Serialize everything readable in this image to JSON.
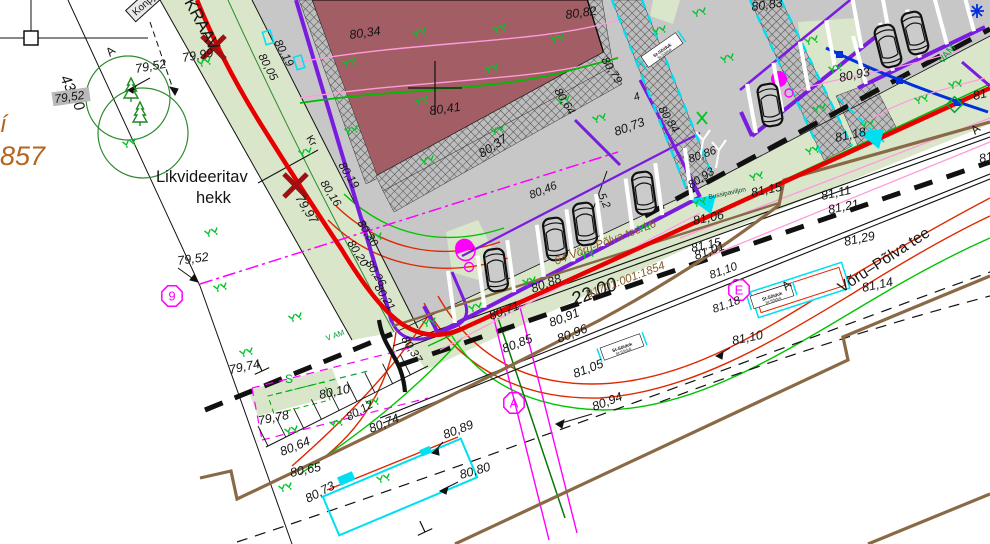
{
  "drawing_meta": {
    "type": "cad-site-plan",
    "road_name": "Võru–Põlva tee",
    "cadastral_number": "91701:001:1854",
    "address_label": "64 Võru-Põlva tee L6",
    "corridor_width": "22.00",
    "boundary_dimension": "43,00",
    "hedge_note": "Likvideeritav hekk",
    "ditch_label": "KRAAV",
    "bus_shelter_label": "Bussipaviljon"
  },
  "colors": {
    "k": "#151515",
    "o": "#b5651d",
    "g": "#00a33a",
    "b": "#8a5a2b",
    "d": "#063f1e",
    "pavement": "#c7c7c7",
    "lawn": "#d9e6c9",
    "building": "#a35d64",
    "red": "#e80000",
    "purple": "#7a1be0",
    "cyan": "#00dff0",
    "magenta": "#ff00ff",
    "brown": "#8a6a46",
    "blue": "#0030dd",
    "pink": "#ff9bdd",
    "green": "#00c400"
  },
  "texts": [
    {
      "t": "43,00",
      "x": 60,
      "y": 78,
      "r": 64,
      "s": 15,
      "n": "dimension-label"
    },
    {
      "t": "Konpju",
      "x": 136,
      "y": 16,
      "r": -42,
      "s": 10,
      "u": 1,
      "box": 1,
      "n": "boxed-note-label"
    },
    {
      "t": "A",
      "x": 110,
      "y": 57,
      "r": -40,
      "s": 12,
      "u": 1,
      "n": "axis-letter"
    },
    {
      "t": "79,52",
      "x": 136,
      "y": 73,
      "r": -10
    },
    {
      "t": "79,52",
      "x": 55,
      "y": 103,
      "r": -8,
      "s": 12,
      "bg": 1
    },
    {
      "t": "í",
      "x": 0,
      "y": 132,
      "s": 24,
      "c": "o",
      "n": "cut-text"
    },
    {
      "t": "857",
      "x": 0,
      "y": 165,
      "s": 27,
      "c": "o",
      "n": "cut-cadastral"
    },
    {
      "t": "Likvideeritav",
      "x": 156,
      "y": 182,
      "s": 16.5,
      "u": 1,
      "n": "hedge-note-line1"
    },
    {
      "t": "hekk",
      "x": 196,
      "y": 203,
      "s": 16.5,
      "u": 1,
      "n": "hedge-note-line2"
    },
    {
      "t": "79,52",
      "x": 178,
      "y": 265,
      "r": -8
    },
    {
      "t": "79,99",
      "x": 183,
      "y": 62,
      "r": -10
    },
    {
      "t": "KRAAV",
      "x": 184,
      "y": 2,
      "r": 62,
      "s": 17,
      "u": 1,
      "n": "ditch-label"
    },
    {
      "t": "80,05",
      "x": 258,
      "y": 56,
      "r": 62,
      "s": 11.5
    },
    {
      "t": "80,19",
      "x": 274,
      "y": 42,
      "r": 62,
      "s": 11.5
    },
    {
      "t": "Kr",
      "x": 306,
      "y": 138,
      "r": 58,
      "s": 10.5,
      "u": 1,
      "n": "note-label"
    },
    {
      "t": "80,19",
      "x": 338,
      "y": 165,
      "r": 58,
      "s": 11.5
    },
    {
      "t": "80,16",
      "x": 320,
      "y": 183,
      "r": 58,
      "s": 11.5
    },
    {
      "t": "79,97",
      "x": 295,
      "y": 198,
      "r": 58
    },
    {
      "t": "80,30",
      "x": 357,
      "y": 223,
      "r": 58,
      "s": 11.5
    },
    {
      "t": "80,20",
      "x": 347,
      "y": 243,
      "r": 58,
      "s": 11.5
    },
    {
      "t": "80,26",
      "x": 365,
      "y": 263,
      "r": 58,
      "s": 11.5
    },
    {
      "t": "80,21",
      "x": 374,
      "y": 287,
      "r": 58,
      "s": 11.5
    },
    {
      "t": "80,37",
      "x": 401,
      "y": 339,
      "r": 58,
      "s": 11.5
    },
    {
      "t": "80,10",
      "x": 320,
      "y": 399,
      "r": -12
    },
    {
      "t": "80,34",
      "x": 350,
      "y": 39,
      "r": -8
    },
    {
      "t": "80,82",
      "x": 566,
      "y": 19,
      "r": -8
    },
    {
      "t": "80,41",
      "x": 430,
      "y": 115,
      "r": -8
    },
    {
      "t": "80,64",
      "x": 554,
      "y": 91,
      "r": 58,
      "s": 11.5
    },
    {
      "t": "80,37",
      "x": 482,
      "y": 158,
      "r": -33
    },
    {
      "t": "80,73",
      "x": 616,
      "y": 136,
      "r": -20
    },
    {
      "t": "80,84",
      "x": 658,
      "y": 109,
      "r": 58,
      "s": 11.5
    },
    {
      "t": "80,86",
      "x": 690,
      "y": 163,
      "r": -20,
      "s": 11.5
    },
    {
      "t": "80,46",
      "x": 531,
      "y": 199,
      "r": -22,
      "s": 11.5
    },
    {
      "t": "5,2",
      "x": 598,
      "y": 195,
      "r": 66,
      "s": 11,
      "n": "dimension-label"
    },
    {
      "t": "4",
      "x": 635,
      "y": 101,
      "r": -20,
      "s": 11,
      "n": "dimension-label"
    },
    {
      "t": "80,79",
      "x": 601,
      "y": 60,
      "r": 58,
      "s": 11.5
    },
    {
      "t": "80,83",
      "x": 752,
      "y": 11,
      "r": -8
    },
    {
      "t": "80,93",
      "x": 691,
      "y": 189,
      "r": -33,
      "s": 11.5
    },
    {
      "t": "80,93",
      "x": 840,
      "y": 82,
      "r": -12
    },
    {
      "t": "81,18",
      "x": 836,
      "y": 142,
      "r": -12
    },
    {
      "t": "81,15",
      "x": 692,
      "y": 252,
      "r": -12,
      "s": 12
    },
    {
      "t": "81,15",
      "x": 752,
      "y": 197,
      "r": -12
    },
    {
      "t": "81,11",
      "x": 822,
      "y": 200,
      "r": -12
    },
    {
      "t": "81,21",
      "x": 829,
      "y": 214,
      "r": -12
    },
    {
      "t": "81,29",
      "x": 845,
      "y": 246,
      "r": -12
    },
    {
      "t": "81,14",
      "x": 863,
      "y": 292,
      "r": -12
    },
    {
      "t": "Võru–Põlva tee",
      "x": 842,
      "y": 293,
      "r": -33,
      "s": 15.5,
      "u": 1,
      "n": "road-name-label"
    },
    {
      "t": "81",
      "x": 974,
      "y": 100,
      "r": -12,
      "n": "cut-label"
    },
    {
      "t": "81",
      "x": 980,
      "y": 163,
      "r": -12,
      "n": "cut-label"
    },
    {
      "t": "81,06",
      "x": 694,
      "y": 225,
      "r": -12
    },
    {
      "t": "81,01",
      "x": 696,
      "y": 260,
      "r": -20
    },
    {
      "t": "81,10",
      "x": 711,
      "y": 279,
      "r": -20,
      "s": 11.5
    },
    {
      "t": "81,18",
      "x": 714,
      "y": 313,
      "r": -20,
      "s": 11.5
    },
    {
      "t": "81,10",
      "x": 733,
      "y": 345,
      "r": -12
    },
    {
      "t": "22.00",
      "x": 574,
      "y": 306,
      "r": -21,
      "s": 19,
      "n": "corridor-width-label"
    },
    {
      "t": "80,88",
      "x": 533,
      "y": 293,
      "r": -21
    },
    {
      "t": "80,71",
      "x": 491,
      "y": 320,
      "r": -21
    },
    {
      "t": "80,91",
      "x": 551,
      "y": 327,
      "r": -21
    },
    {
      "t": "80,85",
      "x": 504,
      "y": 353,
      "r": -21
    },
    {
      "t": "80,96",
      "x": 559,
      "y": 343,
      "r": -21
    },
    {
      "t": "81,05",
      "x": 575,
      "y": 378,
      "r": -21
    },
    {
      "t": "80,94",
      "x": 594,
      "y": 411,
      "r": -21
    },
    {
      "t": "80,89",
      "x": 445,
      "y": 439,
      "r": -21
    },
    {
      "t": "80,80",
      "x": 461,
      "y": 479,
      "r": -16
    },
    {
      "t": "79,74",
      "x": 230,
      "y": 374,
      "r": -12
    },
    {
      "t": "79,78",
      "x": 259,
      "y": 425,
      "r": -12
    },
    {
      "t": "80,12",
      "x": 349,
      "y": 421,
      "r": -30,
      "s": 11.5
    },
    {
      "t": "80,74",
      "x": 371,
      "y": 433,
      "r": -22
    },
    {
      "t": "80,64",
      "x": 282,
      "y": 456,
      "r": -22
    },
    {
      "t": "80,65",
      "x": 291,
      "y": 477,
      "r": -12
    },
    {
      "t": "80,73",
      "x": 308,
      "y": 503,
      "r": -28
    },
    {
      "t": "A",
      "x": 589,
      "y": 299,
      "r": -40,
      "s": 12,
      "u": 1,
      "n": "axis-letter"
    },
    {
      "t": "A",
      "x": 786,
      "y": 291,
      "r": -40,
      "s": 12,
      "u": 1,
      "n": "axis-letter"
    },
    {
      "t": "A",
      "x": 975,
      "y": 135,
      "r": -40,
      "s": 12,
      "u": 1,
      "n": "axis-letter"
    },
    {
      "t": "VAM",
      "x": 943,
      "y": 64,
      "r": -52,
      "s": 10,
      "c": "g",
      "u": 1,
      "n": "utility-label"
    },
    {
      "t": "V AM",
      "x": 327,
      "y": 341,
      "r": -20,
      "s": 8,
      "c": "g",
      "u": 1,
      "n": "utility-label"
    },
    {
      "t": "S",
      "x": 285,
      "y": 383,
      "s": 12,
      "c": "g",
      "u": 1,
      "n": "utility-label"
    },
    {
      "t": "Bussipaviljon",
      "x": 709,
      "y": 199,
      "r": -12,
      "s": 6.5,
      "c": "d",
      "u": 1,
      "n": "bus-shelter-label"
    },
    {
      "t": "64 Võru-Põlva tee L6",
      "x": 556,
      "y": 265,
      "r": -21,
      "s": 11.5,
      "c": "b",
      "n": "address-label"
    },
    {
      "t": "91701:001:1854",
      "x": 588,
      "y": 298,
      "r": -21,
      "s": 11.5,
      "c": "b",
      "n": "cadastral-label"
    }
  ],
  "circled_points": [
    {
      "letter": "9",
      "x": 172,
      "y": 296
    },
    {
      "letter": "A",
      "x": 514,
      "y": 403
    },
    {
      "letter": "E",
      "x": 739,
      "y": 290
    }
  ],
  "sign_boxes": [
    {
      "t": "St-Sõiduk",
      "x": 662,
      "y": 50,
      "r": -35
    },
    {
      "t": "St-Sõiduk",
      "x": 772,
      "y": 296,
      "r": -18
    },
    {
      "t": "St-Sõiduk",
      "x": 622,
      "y": 347,
      "r": -20
    }
  ],
  "symbols": {
    "cars": [
      {
        "x": 496,
        "y": 270,
        "r": -8
      },
      {
        "x": 555,
        "y": 239,
        "r": -8
      },
      {
        "x": 585,
        "y": 224,
        "r": -8
      },
      {
        "x": 644,
        "y": 193,
        "r": -8
      },
      {
        "x": 770,
        "y": 105,
        "r": -10
      },
      {
        "x": 888,
        "y": 46,
        "r": -14
      },
      {
        "x": 915,
        "y": 33,
        "r": -14
      }
    ],
    "trees": [
      {
        "x": 131,
        "y": 90
      },
      {
        "x": 140,
        "y": 114
      }
    ],
    "grass": [
      [
        205,
        62
      ],
      [
        130,
        143
      ],
      [
        306,
        152
      ],
      [
        212,
        232
      ],
      [
        296,
        317
      ],
      [
        376,
        237
      ],
      [
        221,
        287
      ],
      [
        247,
        352
      ],
      [
        373,
        402
      ],
      [
        292,
        430
      ],
      [
        337,
        423
      ],
      [
        286,
        487
      ],
      [
        384,
        478
      ],
      [
        350,
        62
      ],
      [
        420,
        32
      ],
      [
        352,
        130
      ],
      [
        422,
        100
      ],
      [
        492,
        68
      ],
      [
        558,
        38
      ],
      [
        428,
        160
      ],
      [
        498,
        130
      ],
      [
        564,
        100
      ],
      [
        500,
        28
      ],
      [
        600,
        118
      ],
      [
        728,
        58
      ],
      [
        820,
        108
      ],
      [
        660,
        30
      ],
      [
        700,
        12
      ],
      [
        476,
        307
      ],
      [
        530,
        281
      ],
      [
        588,
        254
      ],
      [
        645,
        227
      ],
      [
        700,
        202
      ],
      [
        757,
        176
      ],
      [
        813,
        150
      ],
      [
        868,
        124
      ],
      [
        922,
        99
      ],
      [
        956,
        84
      ],
      [
        430,
        322
      ],
      [
        812,
        40
      ],
      [
        836,
        68
      ]
    ]
  }
}
